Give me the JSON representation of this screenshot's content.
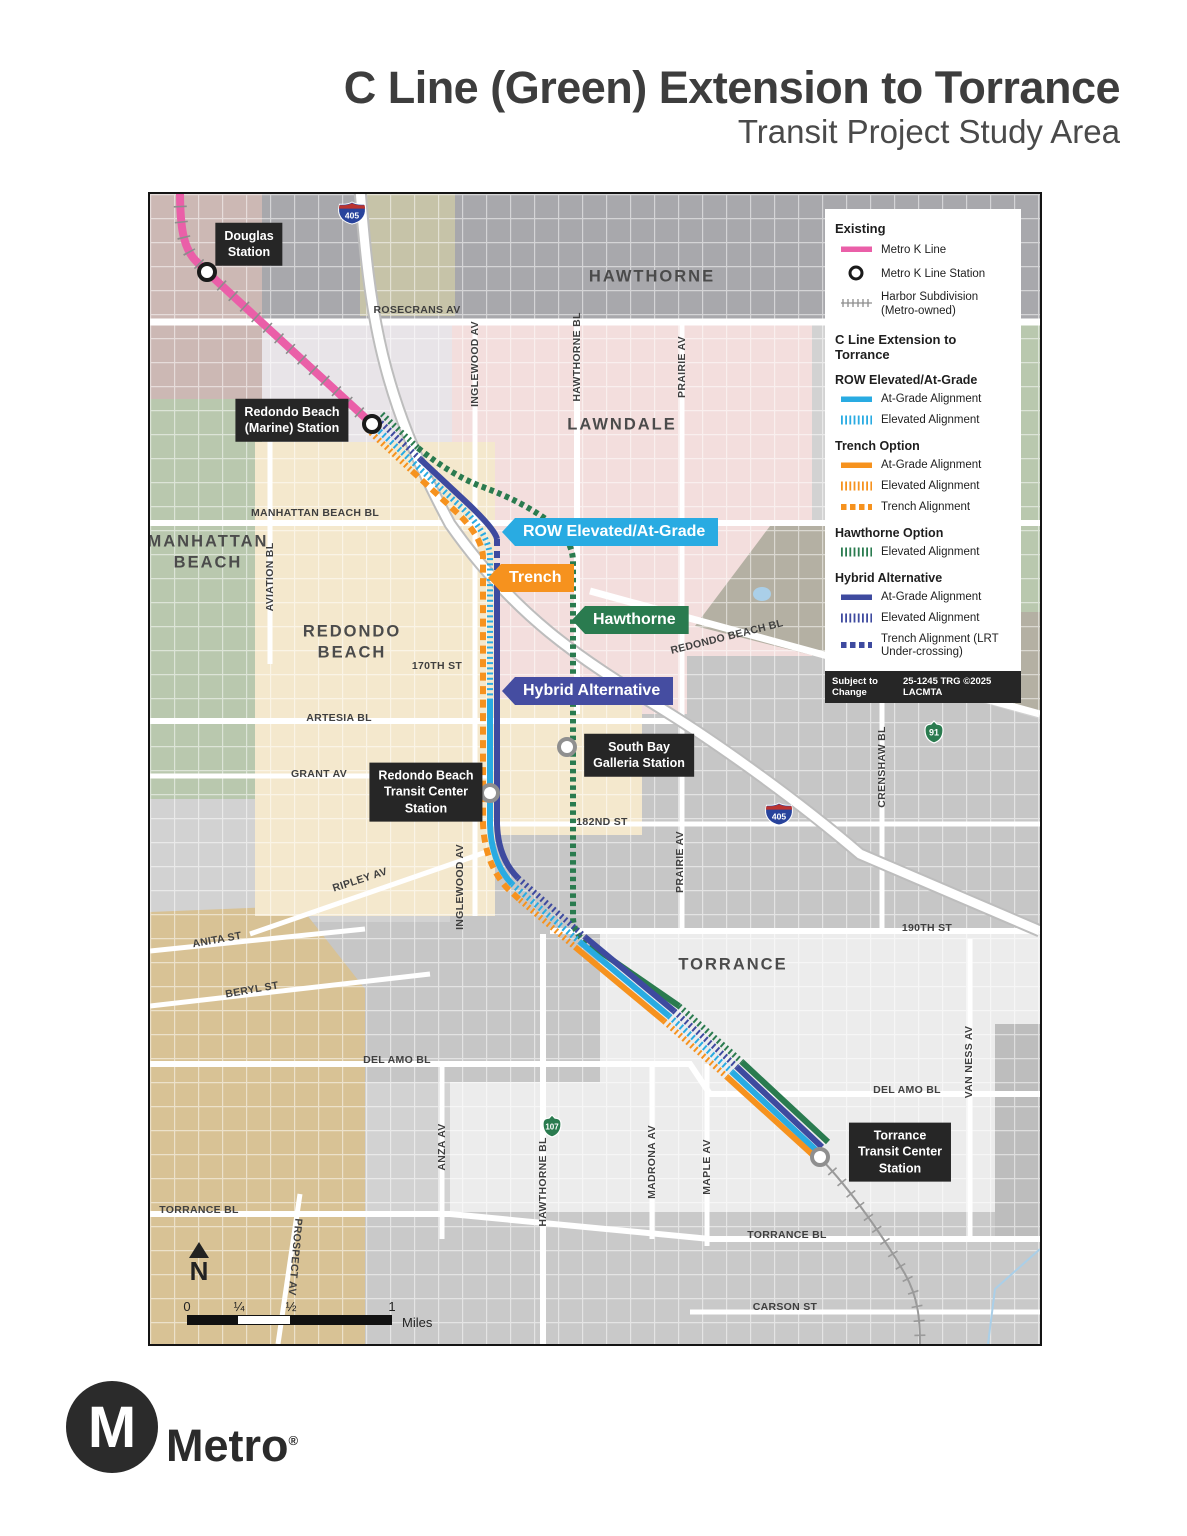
{
  "header": {
    "title": "C Line (Green) Extension to Torrance",
    "subtitle": "Transit Project Study Area"
  },
  "map": {
    "cities": [
      {
        "lines": [
          "HAWTHORNE"
        ]
      },
      {
        "lines": [
          "LAWNDALE"
        ]
      },
      {
        "lines": [
          "MANHATTAN",
          "BEACH"
        ]
      },
      {
        "lines": [
          "REDONDO",
          "BEACH"
        ]
      },
      {
        "lines": [
          "TORRANCE"
        ]
      }
    ],
    "streets": [
      {
        "label": "ROSECRANS AV"
      },
      {
        "label": "INGLEWOOD AV"
      },
      {
        "label": "HAWTHORNE BL"
      },
      {
        "label": "PRAIRIE AV"
      },
      {
        "label": "MANHATTAN BEACH BL"
      },
      {
        "label": "AVIATION BL"
      },
      {
        "label": "REDONDO BEACH BL"
      },
      {
        "label": "170TH ST"
      },
      {
        "label": "ARTESIA BL"
      },
      {
        "label": "GRANT AV"
      },
      {
        "label": "182ND ST"
      },
      {
        "label": "CRENSHAW BL"
      },
      {
        "label": "RIPLEY AV"
      },
      {
        "label": "INGLEWOOD AV"
      },
      {
        "label": "PRAIRIE AV"
      },
      {
        "label": "ANITA ST"
      },
      {
        "label": "190TH ST"
      },
      {
        "label": "BERYL ST"
      },
      {
        "label": "DEL AMO BL"
      },
      {
        "label": "DEL AMO BL"
      },
      {
        "label": "VAN NESS AV"
      },
      {
        "label": "ANZA AV"
      },
      {
        "label": "HAWTHORNE BL"
      },
      {
        "label": "MADRONA AV"
      },
      {
        "label": "MAPLE AV"
      },
      {
        "label": "TORRANCE BL"
      },
      {
        "label": "PROSPECT AV"
      },
      {
        "label": "TORRANCE BL"
      },
      {
        "label": "CARSON ST"
      }
    ],
    "stations": [
      {
        "lines": [
          "Douglas",
          "Station"
        ]
      },
      {
        "lines": [
          "Redondo Beach",
          "(Marine) Station"
        ]
      },
      {
        "lines": [
          "South Bay",
          "Galleria Station"
        ]
      },
      {
        "lines": [
          "Redondo Beach",
          "Transit Center",
          "Station"
        ]
      },
      {
        "lines": [
          "Torrance",
          "Transit Center",
          "Station"
        ]
      }
    ],
    "flags": [
      {
        "label": "ROW Elevated/At-Grade"
      },
      {
        "label": "Trench"
      },
      {
        "label": "Hawthorne"
      },
      {
        "label": "Hybrid Alternative"
      }
    ],
    "shields": [
      {
        "type": "interstate",
        "number": "405"
      },
      {
        "type": "interstate",
        "number": "405"
      },
      {
        "type": "state",
        "number": "91"
      },
      {
        "type": "state",
        "number": "107"
      }
    ],
    "north_label": "N",
    "scale": {
      "ticks": [
        "0",
        "¼",
        "½",
        "1"
      ],
      "unit": "Miles"
    }
  },
  "legend": {
    "sections": [
      {
        "header": "Existing",
        "items": [
          {
            "swatch": "kline-solid",
            "label": "Metro K Line"
          },
          {
            "swatch": "station-circle",
            "label": "Metro K Line Station"
          },
          {
            "swatch": "harbor-hatch",
            "label": "Harbor Subdivision (Metro-owned)"
          }
        ]
      },
      {
        "header": "C Line Extension to Torrance",
        "subgroups": [
          {
            "subheader": "ROW Elevated/At-Grade",
            "items": [
              {
                "swatch": "blue-solid",
                "label": "At-Grade Alignment"
              },
              {
                "swatch": "blue-ticks",
                "label": "Elevated Alignment"
              }
            ]
          },
          {
            "subheader": "Trench Option",
            "items": [
              {
                "swatch": "orange-solid",
                "label": "At-Grade Alignment"
              },
              {
                "swatch": "orange-ticks",
                "label": "Elevated Alignment"
              },
              {
                "swatch": "orange-dash",
                "label": "Trench Alignment"
              }
            ]
          },
          {
            "subheader": "Hawthorne Option",
            "items": [
              {
                "swatch": "green-ticks",
                "label": "Elevated Alignment"
              }
            ]
          },
          {
            "subheader": "Hybrid Alternative",
            "items": [
              {
                "swatch": "navy-solid",
                "label": "At-Grade Alignment"
              },
              {
                "swatch": "navy-ticks",
                "label": "Elevated Alignment"
              },
              {
                "swatch": "navy-dash",
                "label": "Trench Alignment (LRT Under-crossing)"
              }
            ]
          }
        ]
      }
    ],
    "footer": {
      "left": "Subject to Change",
      "right": "25-1245 TRG ©2025 LACMTA"
    }
  },
  "logo": {
    "monogram": "M",
    "wordmark": "Metro",
    "registered": "®"
  },
  "colors": {
    "k_line_pink": "#ea5fa8",
    "row_blue": "#29abe2",
    "trench_orange": "#f6921e",
    "hawthorne_green": "#2a7b4f",
    "hybrid_navy": "#3e4a9f",
    "harbor_gray": "#909090",
    "label_box": "#262626",
    "title_text": "#3d3d3d"
  }
}
